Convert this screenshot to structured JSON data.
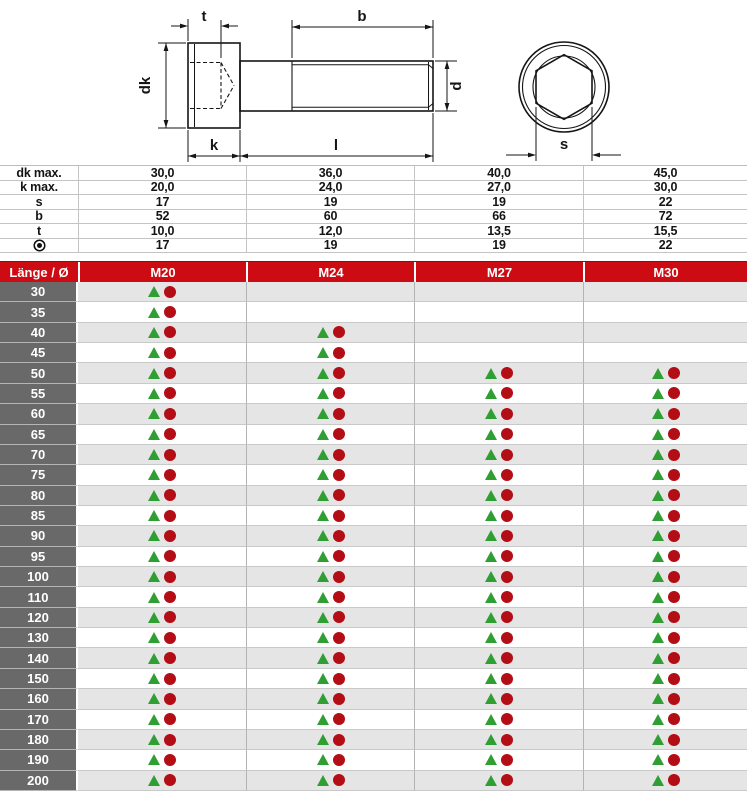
{
  "drawing": {
    "description": "socket-head-cap-screw-dimension-drawing",
    "labels": {
      "socket_depth": "t",
      "thread_length": "b",
      "head_diameter": "dk",
      "thread_diameter": "d",
      "head_height": "k",
      "screw_length": "l",
      "hex_socket_size": "s"
    }
  },
  "spec": {
    "rows": [
      {
        "label": "dk max.",
        "values": [
          "30,0",
          "36,0",
          "40,0",
          "45,0"
        ]
      },
      {
        "label": "k max.",
        "values": [
          "20,0",
          "24,0",
          "27,0",
          "30,0"
        ]
      },
      {
        "label": "s",
        "values": [
          "17",
          "19",
          "19",
          "22"
        ]
      },
      {
        "label": "b",
        "values": [
          "52",
          "60",
          "66",
          "72"
        ]
      },
      {
        "label": "t",
        "values": [
          "10,0",
          "12,0",
          "13,5",
          "15,5"
        ]
      },
      {
        "label": "",
        "label_icon": "fisheye-icon",
        "values": [
          "17",
          "19",
          "19",
          "22"
        ]
      }
    ]
  },
  "size_header": {
    "label": "Länge / Ø",
    "columns": [
      "M20",
      "M24",
      "M27",
      "M30"
    ]
  },
  "availability": {
    "legend": {
      "triangle_icon": "triangle-availability-icon",
      "circle_icon": "circle-availability-icon"
    },
    "rows": [
      {
        "length": "30",
        "available": [
          true,
          false,
          false,
          false
        ]
      },
      {
        "length": "35",
        "available": [
          true,
          false,
          false,
          false
        ]
      },
      {
        "length": "40",
        "available": [
          true,
          true,
          false,
          false
        ]
      },
      {
        "length": "45",
        "available": [
          true,
          true,
          false,
          false
        ]
      },
      {
        "length": "50",
        "available": [
          true,
          true,
          true,
          true
        ]
      },
      {
        "length": "55",
        "available": [
          true,
          true,
          true,
          true
        ]
      },
      {
        "length": "60",
        "available": [
          true,
          true,
          true,
          true
        ]
      },
      {
        "length": "65",
        "available": [
          true,
          true,
          true,
          true
        ]
      },
      {
        "length": "70",
        "available": [
          true,
          true,
          true,
          true
        ]
      },
      {
        "length": "75",
        "available": [
          true,
          true,
          true,
          true
        ]
      },
      {
        "length": "80",
        "available": [
          true,
          true,
          true,
          true
        ]
      },
      {
        "length": "85",
        "available": [
          true,
          true,
          true,
          true
        ]
      },
      {
        "length": "90",
        "available": [
          true,
          true,
          true,
          true
        ]
      },
      {
        "length": "95",
        "available": [
          true,
          true,
          true,
          true
        ]
      },
      {
        "length": "100",
        "available": [
          true,
          true,
          true,
          true
        ]
      },
      {
        "length": "110",
        "available": [
          true,
          true,
          true,
          true
        ]
      },
      {
        "length": "120",
        "available": [
          true,
          true,
          true,
          true
        ]
      },
      {
        "length": "130",
        "available": [
          true,
          true,
          true,
          true
        ]
      },
      {
        "length": "140",
        "available": [
          true,
          true,
          true,
          true
        ]
      },
      {
        "length": "150",
        "available": [
          true,
          true,
          true,
          true
        ]
      },
      {
        "length": "160",
        "available": [
          true,
          true,
          true,
          true
        ]
      },
      {
        "length": "170",
        "available": [
          true,
          true,
          true,
          true
        ]
      },
      {
        "length": "180",
        "available": [
          true,
          true,
          true,
          true
        ]
      },
      {
        "length": "190",
        "available": [
          true,
          true,
          true,
          true
        ]
      },
      {
        "length": "200",
        "available": [
          true,
          true,
          true,
          true
        ]
      }
    ]
  },
  "colors": {
    "header_red": "#cc0b12",
    "header_red_dark": "#8d0d10",
    "label_cell_gray": "#696969",
    "stripe_gray": "#e5e5e5",
    "grid_vertical": "#b3b3b3",
    "grid_horizontal": "#c9c9c9",
    "triangle_green": "#2f9e33",
    "circle_red": "#b30d15"
  }
}
